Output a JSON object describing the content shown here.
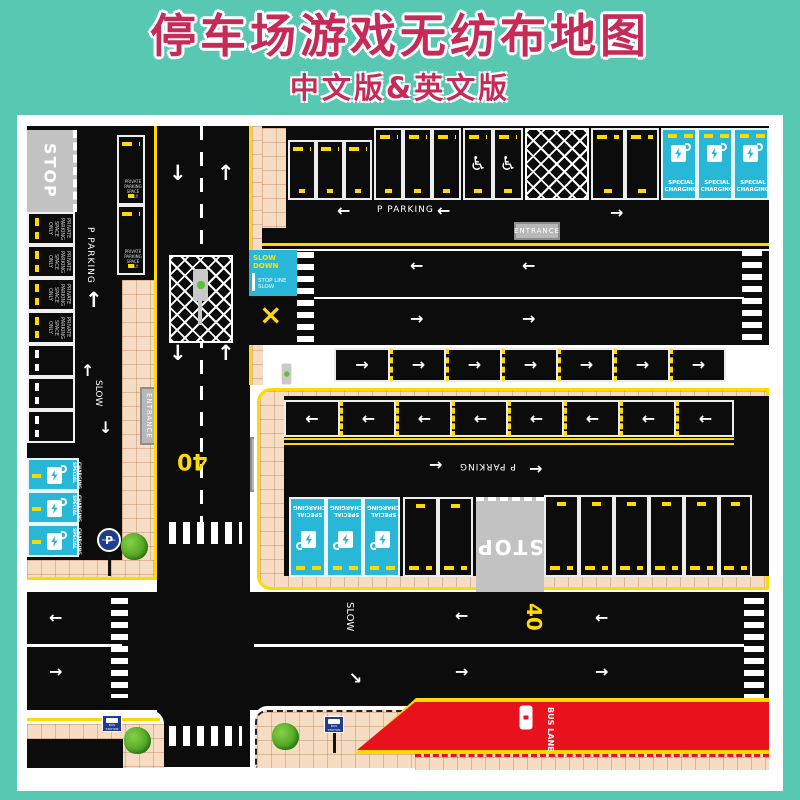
{
  "header": {
    "title": "停车场游戏无纺布地图",
    "subtitle": "中文版&英文版"
  },
  "labels": {
    "stop": "STOP",
    "p": "P",
    "parking": "PARKING",
    "p_parking": "P  PARKING",
    "entrance": "ENTRANCE",
    "slow": "SLOW",
    "slow_down": "SLOW DOWN",
    "stop_line_slow": "STOP LINE SLOW",
    "special": "SPECIAL",
    "charging": "CHARGING",
    "private_full": "PRIVATE PARKING SPACE ONLY",
    "speed": "40",
    "bus": "BUS",
    "lane": "LANE",
    "bus_station": "BUS STATION"
  },
  "glyphs": {
    "left": "←",
    "right": "→",
    "up": "↑",
    "down": "↓",
    "wheelchair": "♿",
    "cross": "×"
  },
  "colors": {
    "background": "#58c8b2",
    "title": "#c62a57",
    "road": "#0c0c0c",
    "charging_cyan": "#29b7d8",
    "bus_lane_red": "#e8121c",
    "sidewalk_tan": "#f7dcc4",
    "marking_yellow": "#ffd900",
    "sign_gray": "#b8b8b8",
    "sign_blue": "#1f3d8f"
  }
}
